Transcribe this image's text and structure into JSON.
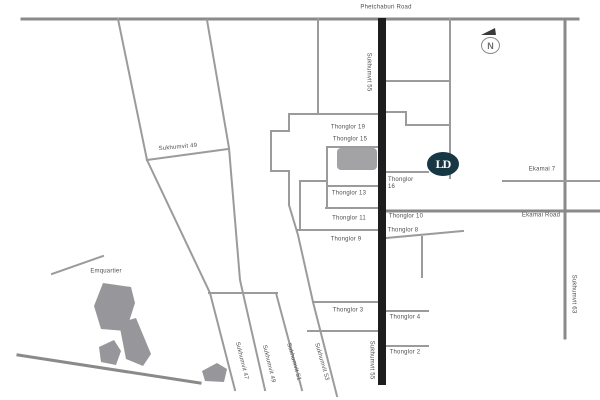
{
  "labels": {
    "phetchaburi_road": "Phetchaburi Road",
    "sukhumvit_55_top": "Sukhumvit 55",
    "sukhumvit_55_bottom": "Sukhumvit 55",
    "sukhumvit_63": "Sukhumvit 63",
    "sukhumvit_49_road": "Sukhumvit 49",
    "emquartier": "Emquartier",
    "sukhumvit_47_soi": "Sukhumvit 47",
    "sukhumvit_49_soi": "Sukhumvit 49",
    "sukhumvit_51_soi": "Sukhumvit 51",
    "sukhumvit_53_soi": "Sukhumvit 53",
    "thonglor_19": "Thonglor 19",
    "thonglor_15": "Thonglor 15",
    "thonglor_13": "Thonglor 13",
    "thonglor_11": "Thonglor 11",
    "thonglor_9": "Thonglor 9",
    "thonglor_3": "Thonglor 3",
    "thonglor_16_line1": "Thonglor",
    "thonglor_16_line2": "16",
    "thonglor_10": "Thonglor 10",
    "thonglor_8": "Thonglor 8",
    "thonglor_4": "Thonglor 4",
    "thonglor_2": "Thonglor 2",
    "ekamai_road": "Ekamai Road",
    "ekamai_7": "Ekamai 7"
  },
  "compass": {
    "letter": "N"
  },
  "logo": {
    "monogram": "LD"
  },
  "colors": {
    "thonglor_main_road": "#1d1d1d",
    "minor_road": "#9b9b9b",
    "major_road": "#8a8a8a",
    "building": "#97979b",
    "logo_background": "#163743",
    "label_text": "#4f4f4f"
  }
}
